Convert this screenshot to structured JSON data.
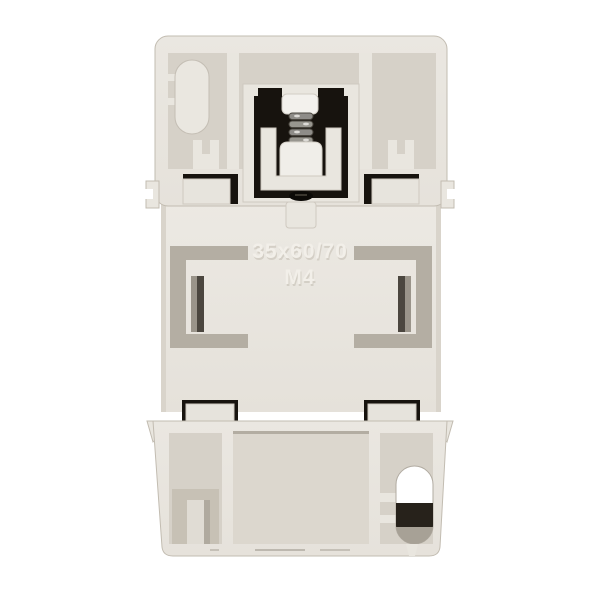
{
  "photo": {
    "description": "Rear view of a light grey plastic switchgear housing with spring-loaded DIN-rail clip",
    "background_color": "#ffffff"
  },
  "device": {
    "marking_line1": "35x60/70",
    "marking_line2": "M4",
    "visible_parts": [
      "spring-clip-mechanism",
      "din-rail-groove-left",
      "din-rail-groove-right",
      "stadium-mount-hole-top",
      "cable-hole-bottom",
      "mounting-tabs"
    ]
  },
  "colors": {
    "background": "#ffffff",
    "plastic_face": "#e9e6df",
    "plastic_face_2": "#e4e0d9",
    "plastic_recess": "#d6d1c8",
    "recess_deep": "#c7c1b5",
    "groove": "#b4aea3",
    "opening": "#17130e",
    "metal": "#8e8c88",
    "hole": "#ffffff",
    "emboss_hi": "#f2efe9",
    "emboss_sh": "#c6c0b5",
    "outline": "#c2bcb1"
  }
}
